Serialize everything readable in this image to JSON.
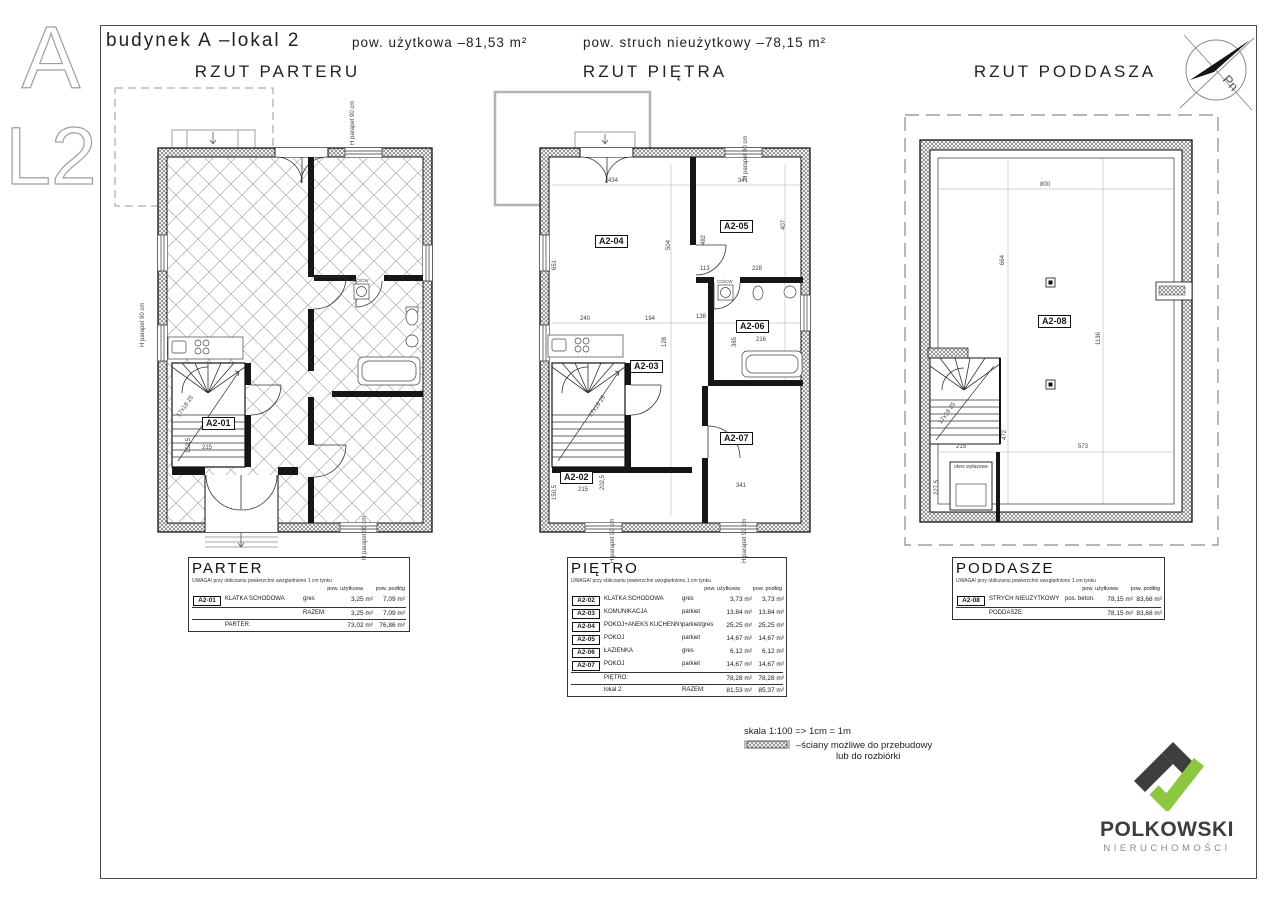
{
  "page": {
    "letter_top": "A",
    "letter_bottom": "L2"
  },
  "header": {
    "title": "budynek A –lokal 2",
    "area_usable": "pow. użytkowa –81,53 m²",
    "area_nonusable": "pow. struch nieużytkowy –78,15 m²"
  },
  "compass": {
    "north": "Pn"
  },
  "plans": [
    {
      "title": "RZUT PARTERU",
      "rooms": [
        {
          "code": "A2-01"
        }
      ],
      "dims": [
        "215",
        "152,5",
        "17x18 25",
        "H parapet 90 cm",
        "H parapet 90 cm",
        "H parapet 90 cm",
        "CO/CW"
      ]
    },
    {
      "title": "RZUT PIĘTRA",
      "rooms": [
        {
          "code": "A2-02"
        },
        {
          "code": "A2-03"
        },
        {
          "code": "A2-04"
        },
        {
          "code": "A2-05"
        },
        {
          "code": "A2-06"
        },
        {
          "code": "A2-07"
        }
      ],
      "dims": [
        "434",
        "341",
        "504",
        "651",
        "482",
        "407",
        "113",
        "228",
        "240",
        "194",
        "138",
        "216",
        "341",
        "215",
        "202,5",
        "150,5",
        "17x18 25",
        "128",
        "385",
        "H parapet 90 cm",
        "CO/CW",
        "H parapet 90 cm",
        "H parapet 90 cm"
      ]
    },
    {
      "title": "RZUT PODDASZA",
      "rooms": [
        {
          "code": "A2-08"
        }
      ],
      "dims": [
        "800",
        "664",
        "1136",
        "573",
        "215",
        "227,5",
        "472",
        "17x18 25"
      ],
      "hatch_window_label": "okno wyłazowe"
    }
  ],
  "tables": [
    {
      "title": "PARTER",
      "note": "UWAGA! przy obliczaniu powierzchni uwzględniono 1 cm tynku",
      "col_area": "pow. użytkowa",
      "col_floor": "pow. podłóg",
      "rows": [
        {
          "code": "A2-01",
          "name": "KLATKA SCHODOWA",
          "finish": "gres",
          "area": "3,25 m²",
          "floor": "7,09 m²"
        }
      ],
      "subtotal": {
        "razem": "RAZEM:",
        "area": "3,25 m²",
        "floor": "7,09 m²"
      },
      "total": {
        "label": "PARTER:",
        "area": "73,02 m²",
        "floor": "76,86 m²"
      }
    },
    {
      "title": "PIĘTRO",
      "note": "UWAGA! przy obliczaniu powierzchni uwzględniono 1 cm tynku",
      "col_area": "pow. użytkowa",
      "col_floor": "pow. podłóg",
      "rows": [
        {
          "code": "A2-02",
          "name": "KLATKA SCHODOWA",
          "finish": "gres",
          "area": "3,73 m²",
          "floor": "3,73 m²"
        },
        {
          "code": "A2-03",
          "name": "KOMUNIKACJA",
          "finish": "parkiet",
          "area": "13,84 m²",
          "floor": "13,84 m²"
        },
        {
          "code": "A2-04",
          "name": "POKÓJ+ANEKS KUCHENNY",
          "finish": "parkiet/gres",
          "area": "25,25 m²",
          "floor": "25,25 m²"
        },
        {
          "code": "A2-05",
          "name": "POKÓJ",
          "finish": "parkiet",
          "area": "14,67 m²",
          "floor": "14,67 m²"
        },
        {
          "code": "A2-06",
          "name": "ŁAZIENKA",
          "finish": "gres",
          "area": "6,12 m²",
          "floor": "6,12 m²"
        },
        {
          "code": "A2-07",
          "name": "POKÓJ",
          "finish": "parkiet",
          "area": "14,67 m²",
          "floor": "14,67 m²"
        }
      ],
      "subtotal": {
        "label": "PIĘTRO:",
        "area": "78,28 m²",
        "floor": "78,28 m²"
      },
      "total": {
        "label": "lokal 2:",
        "razem": "RAZEM:",
        "area": "81,53 m²",
        "floor": "85,37 m²"
      }
    },
    {
      "title": "PODDASZE",
      "note": "UWAGA! przy obliczaniu powierzchni uwzględniono 1 cm tynku",
      "col_area": "pow. użytkowa",
      "col_floor": "pow. podłóg",
      "rows": [
        {
          "code": "A2-08",
          "name": "STRYCH NIEUŻYTKOWY",
          "finish": "pos. beton.",
          "area": "78,15 m²",
          "floor": "83,68 m²"
        }
      ],
      "total": {
        "label": "PODDASZE:",
        "area": "78,15 m²",
        "floor": "83,68 m²"
      }
    }
  ],
  "legend": {
    "scale": "skala 1:100 => 1cm = 1m",
    "wall_note_line1": "–ściany możliwe do przebudowy",
    "wall_note_line2": "lub do rozbiórki"
  },
  "logo": {
    "name": "POLKOWSKI",
    "subtitle": "NIERUCHOMOŚCI",
    "accent_green": "#8dc63f",
    "dark": "#3d3d3f"
  }
}
